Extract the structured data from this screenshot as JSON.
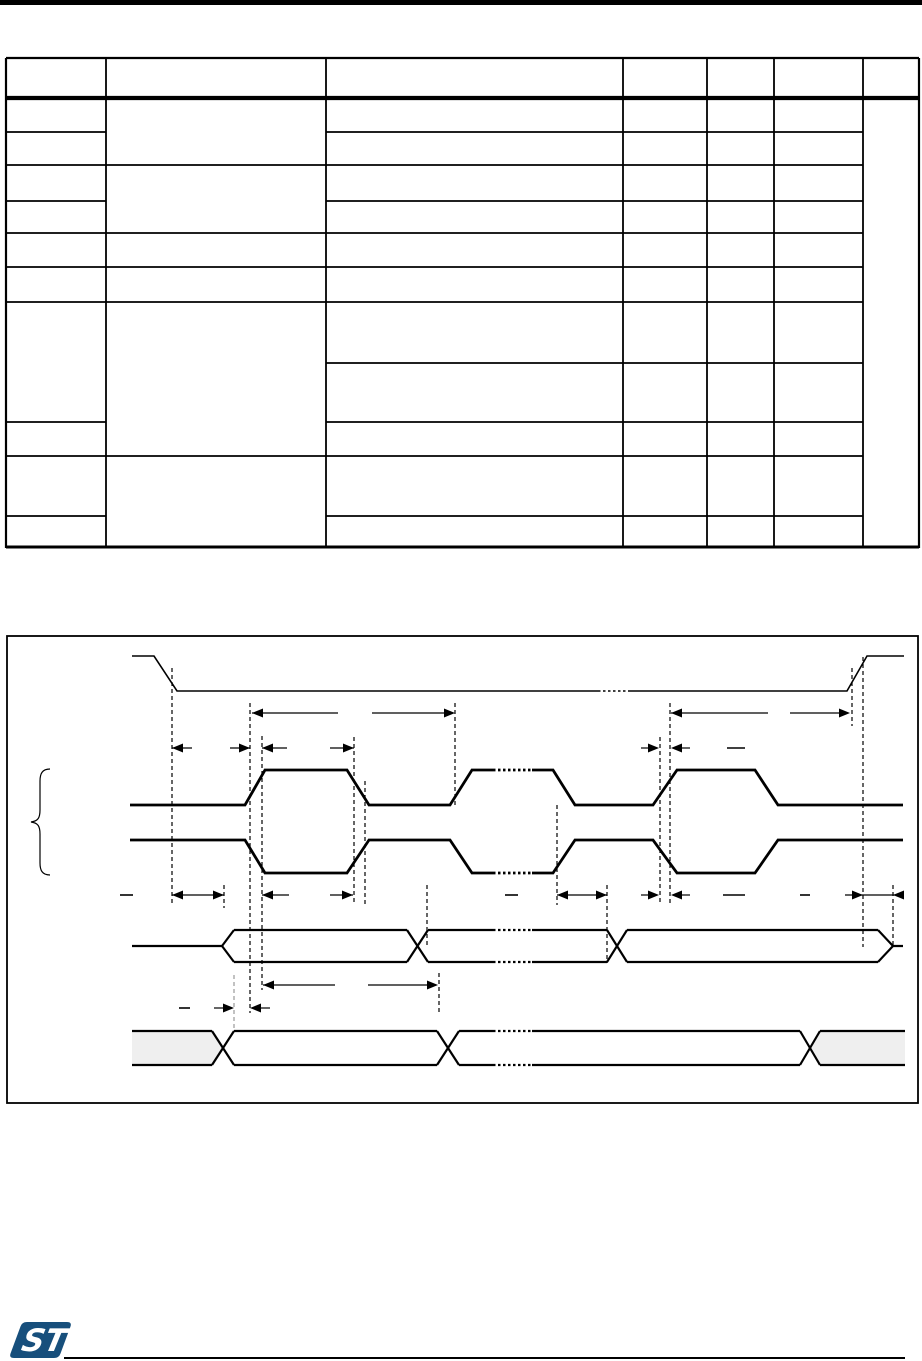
{
  "page": {
    "kind": "datasheet-page-render",
    "background": "#ffffff",
    "line_color": "#000000",
    "text_visible": false
  },
  "header_bar": {
    "color": "#000000"
  },
  "table": {
    "columns": 7,
    "header_rows": 1,
    "body_rows": 11,
    "all_cells_empty": true,
    "merged_last_column": true
  },
  "figure": {
    "border_color": "#000000",
    "bus_fill": "#efefef",
    "dash_guide_color": "#000000",
    "gray_guide_color": "#999999",
    "signals": [
      "chip-select-active-low",
      "clock-polarity-0",
      "clock-polarity-1",
      "data-output-bus",
      "data-input-bus"
    ],
    "label_text": ""
  },
  "footer": {
    "logo": "st-logo",
    "logo_color": "#174f7c",
    "logo_text": "ST",
    "rule_color": "#000000"
  }
}
